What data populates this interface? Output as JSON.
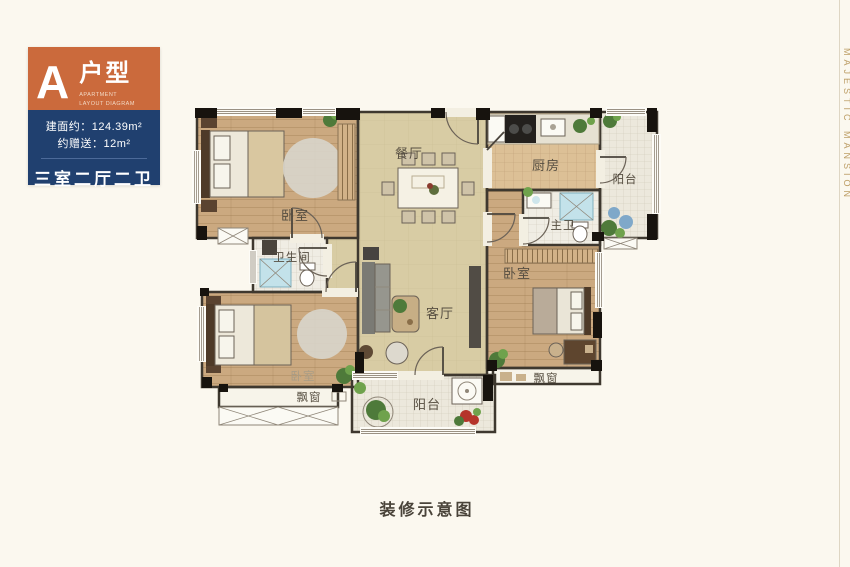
{
  "badge": {
    "letter": "A",
    "type_label": "户型",
    "subtitle_line1": "APARTMENT",
    "subtitle_line2": "LAYOUT DIAGRAM",
    "area_text": "建面约：124.39m²",
    "gift_text": "约赠送：12m²",
    "layout_text": "三室二厅二卫"
  },
  "plan": {
    "labels": {
      "dining": "餐厅",
      "kitchen": "厨房",
      "balcony_top": "阳台",
      "balcony_bottom": "阳台",
      "master_bath": "主卫",
      "bathroom": "卫生间",
      "living": "客厅",
      "bedroom_top_left": "卧室",
      "bedroom_bottom_left": "卧室",
      "bedroom_right": "卧室",
      "bay_window_left": "飘窗",
      "bay_window_right": "飘窗"
    }
  },
  "caption": "装修示意图",
  "watermark": "MAJESTIC MANSION",
  "colors": {
    "badge_orange": "#CB6A3C",
    "badge_blue": "#20406F",
    "background": "#FBF8EF",
    "watermark_gold": "#BD9E66",
    "wood_floor": "#CBA980",
    "tile_floor": "#D8CCA4",
    "wall_dark": "#17130E"
  }
}
